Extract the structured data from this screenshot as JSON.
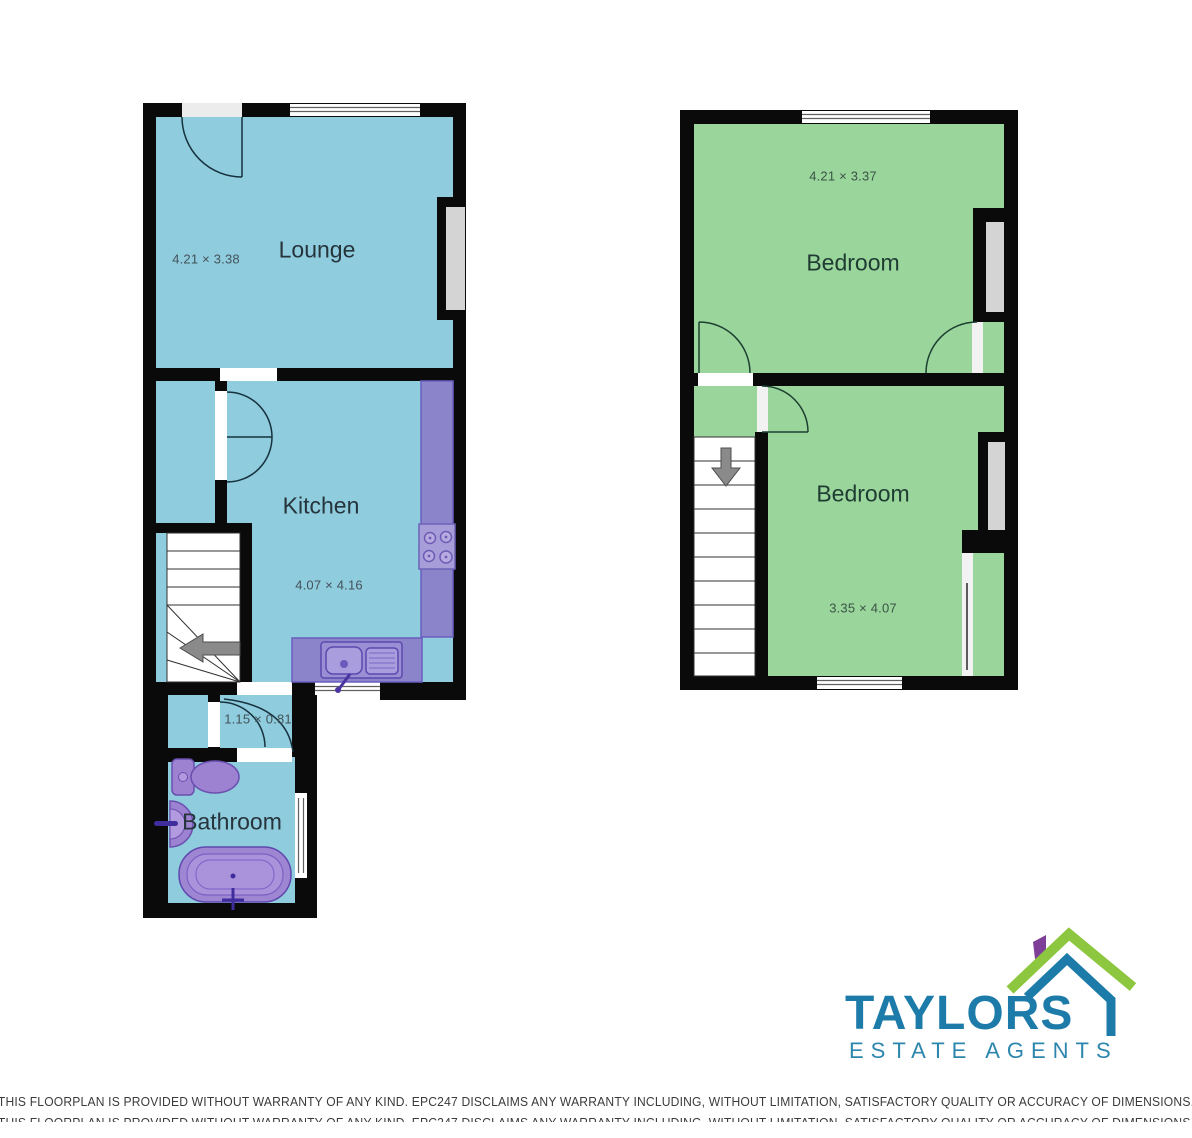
{
  "ground_floor": {
    "lounge": {
      "name": "Lounge",
      "dimensions": "4.21 × 3.38"
    },
    "kitchen": {
      "name": "Kitchen",
      "dimensions": "4.07 × 4.16"
    },
    "hallway": {
      "dimensions": "1.15 × 0.81"
    },
    "bathroom": {
      "name": "Bathroom"
    }
  },
  "first_floor": {
    "bedroom_front": {
      "name": "Bedroom",
      "dimensions": "4.21 × 3.37"
    },
    "bedroom_back": {
      "name": "Bedroom",
      "dimensions": "3.35 × 4.07"
    }
  },
  "logo": {
    "brand": "TAYLORS",
    "tagline": "ESTATE AGENTS"
  },
  "disclaimer": "THIS FLOORPLAN IS PROVIDED WITHOUT WARRANTY OF ANY KIND. EPC247 DISCLAIMS ANY WARRANTY INCLUDING, WITHOUT LIMITATION, SATISFACTORY QUALITY OR ACCURACY OF DIMENSIONS.",
  "colors": {
    "wall": "#0a0a0a",
    "room_blue": "#8fccdd",
    "room_green": "#9ad59b",
    "recess_gray": "#d4d4d4",
    "counter_purple": "#8b84cb",
    "fixture_purple": "#9d82d1",
    "brand_teal": "#1d7ba9",
    "brand_green": "#8dc63f",
    "brand_purple": "#7d3f98"
  }
}
